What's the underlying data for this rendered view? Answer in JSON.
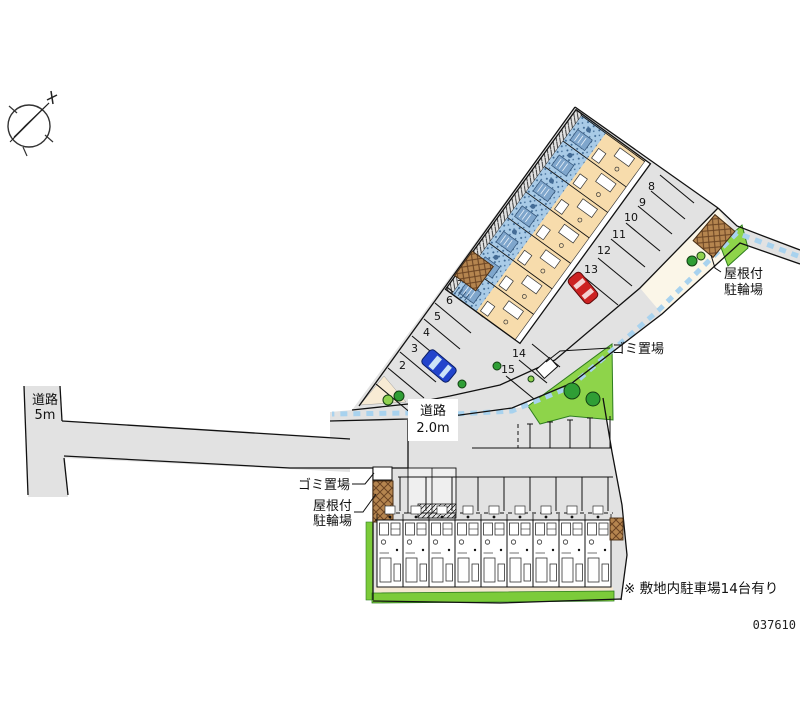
{
  "plan": {
    "note": "※ 敷地内駐車場14台有り",
    "plan_number": "037610"
  },
  "roads": {
    "west_road": {
      "line1": "道路",
      "line2": "5m"
    },
    "north_road": {
      "line1": "道路",
      "line2": "2.0m"
    }
  },
  "labels": {
    "garbage_upper": "ゴミ置場",
    "garbage_lower": "ゴミ置場",
    "bike_upper": {
      "line1": "屋根付",
      "line2": "駐輪場"
    },
    "bike_lower": {
      "line1": "屋根付",
      "line2": "駐輪場"
    }
  },
  "parking": {
    "west_stalls": [
      "2",
      "3",
      "4",
      "5",
      "6",
      "7"
    ],
    "east_stalls": [
      "8",
      "9",
      "10",
      "11",
      "12",
      "13"
    ],
    "south_stalls": [
      "14",
      "15"
    ]
  },
  "colors": {
    "pavement": "#E2E2E2",
    "building_room": "#F7DCAC",
    "building_balcony": "#A9CBE7",
    "green": "#7CCB3A",
    "tree": "#2F9E35",
    "bike_roof": "#B5854F",
    "gutter": "#A8D2EE",
    "car_red": "#CC2222",
    "car_blue": "#2244CC"
  }
}
